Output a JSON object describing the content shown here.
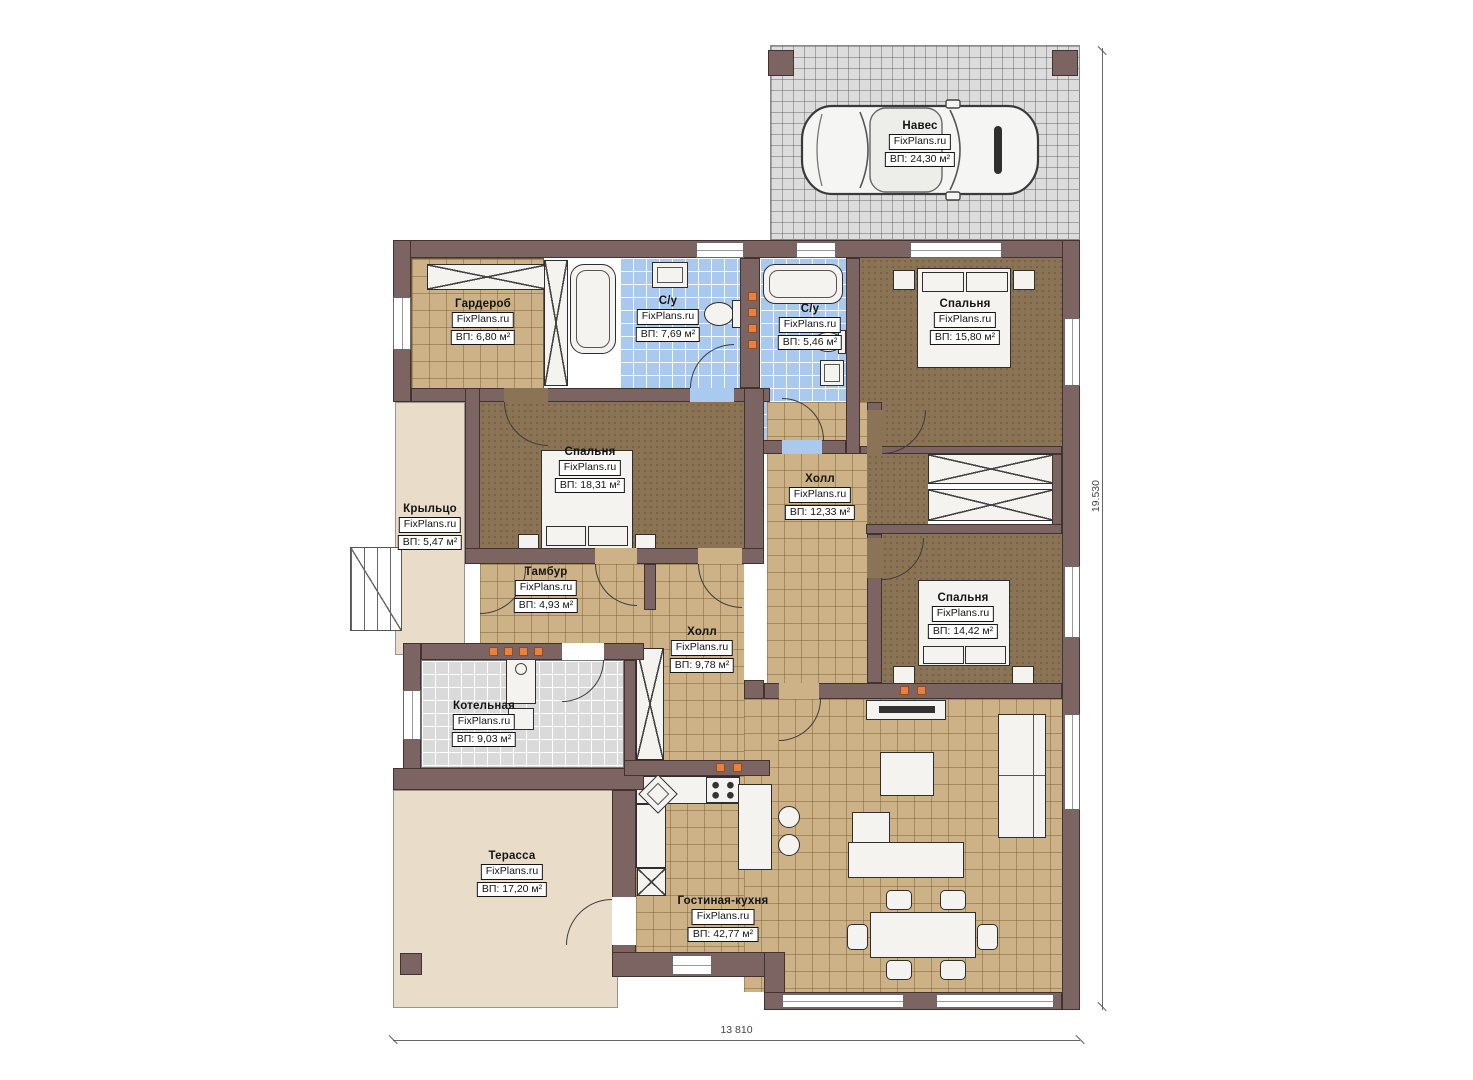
{
  "rooms": [
    {
      "id": "naves",
      "name": "Навес",
      "brand": "FixPlans.ru",
      "area": "ВП: 24,30 м²"
    },
    {
      "id": "garderob",
      "name": "Гардероб",
      "brand": "FixPlans.ru",
      "area": "ВП: 6,80 м²"
    },
    {
      "id": "su1",
      "name": "С/у",
      "brand": "FixPlans.ru",
      "area": "ВП: 7,69 м²"
    },
    {
      "id": "su2",
      "name": "С/у",
      "brand": "FixPlans.ru",
      "area": "ВП: 5,46 м²"
    },
    {
      "id": "bedroom1",
      "name": "Спальня",
      "brand": "FixPlans.ru",
      "area": "ВП: 15,80 м²"
    },
    {
      "id": "bedroom2",
      "name": "Спальня",
      "brand": "FixPlans.ru",
      "area": "ВП: 18,31 м²"
    },
    {
      "id": "hall1",
      "name": "Холл",
      "brand": "FixPlans.ru",
      "area": "ВП: 12,33 м²"
    },
    {
      "id": "kryltso",
      "name": "Крыльцо",
      "brand": "FixPlans.ru",
      "area": "ВП: 5,47 м²"
    },
    {
      "id": "tambur",
      "name": "Тамбур",
      "brand": "FixPlans.ru",
      "area": "ВП: 4,93 м²"
    },
    {
      "id": "hall2",
      "name": "Холл",
      "brand": "FixPlans.ru",
      "area": "ВП: 9,78 м²"
    },
    {
      "id": "bedroom3",
      "name": "Спальня",
      "brand": "FixPlans.ru",
      "area": "ВП: 14,42 м²"
    },
    {
      "id": "kotelnaya",
      "name": "Котельная",
      "brand": "FixPlans.ru",
      "area": "ВП: 9,03 м²"
    },
    {
      "id": "terrassa",
      "name": "Терасса",
      "brand": "FixPlans.ru",
      "area": "ВП: 17,20 м²"
    },
    {
      "id": "gostinaya",
      "name": "Гостиная-кухня",
      "brand": "FixPlans.ru",
      "area": "ВП: 42,77 м²"
    }
  ],
  "dimensions": {
    "bottom": "13 810",
    "right": "19.530"
  },
  "icons": {
    "car": "car-top-view-icon"
  },
  "colors": {
    "wall": "#7b6461",
    "tile_tan": "#cdb287",
    "tile_blue": "#a9c9ee",
    "tile_gray": "#dadada",
    "floor_brown": "#8b7355",
    "floor_beige": "#e9ddc9",
    "carport_grid": "#dcdcdc",
    "accent_orange": "#e8813f"
  }
}
